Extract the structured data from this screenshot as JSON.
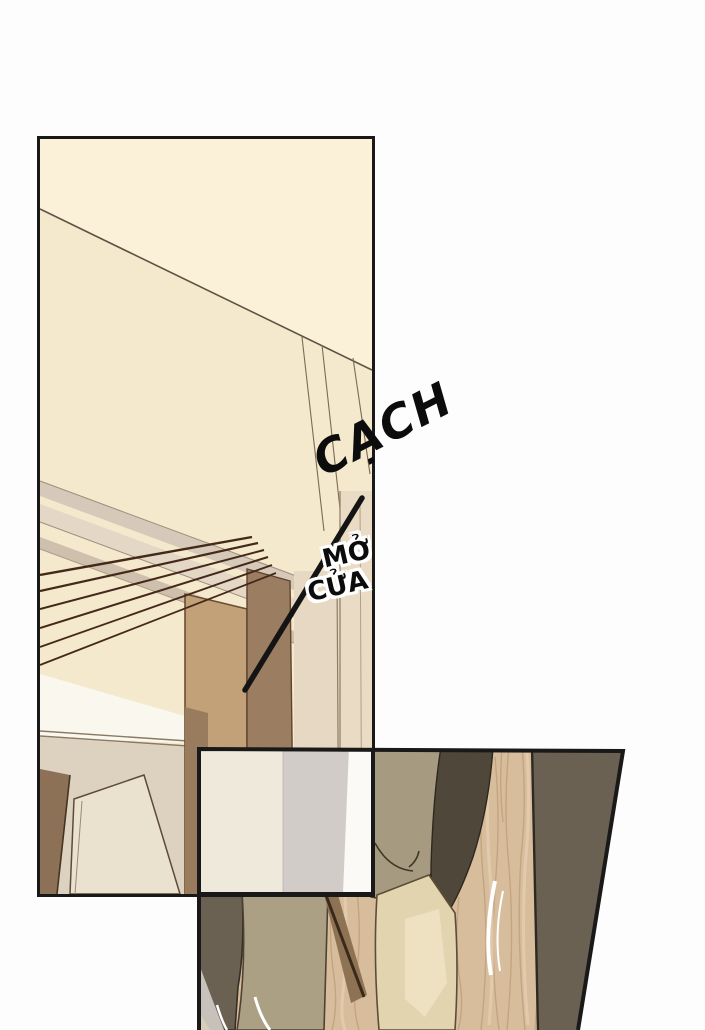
{
  "page": {
    "kind": "comic page",
    "background": "#fdfdfd",
    "width_px": 705,
    "height_px": 1030
  },
  "sfx": {
    "cach": "CẠCH",
    "mo_cua_line1": "MỞ",
    "mo_cua_line2": "CỬA"
  },
  "panels": [
    {
      "id": "panel-1",
      "description": "tall interior panel: cream wall, slanted ceiling beams, wooden door frame, hallway"
    },
    {
      "id": "panel-2",
      "description": "overlapping lower panel: close-up of legs and feet at an open door on a wood floor"
    }
  ],
  "colors": {
    "panel_border": "#191919",
    "wall_cream_top": "#fbf1d9",
    "wall_cream_lower": "#f4e8cd",
    "beam_band_light": "#e4d7c6",
    "beam_band_mid": "#d7c9b9",
    "rail_line_dark": "#44281a",
    "ceiling_white": "#faf7ef",
    "hall_wall_beige": "#ddd1c0",
    "pillar_light_wood": "#c2a078",
    "pillar_dark_wood": "#9b7e62",
    "door_frame_brown": "#8d7156",
    "wood_floor": "#d8bd9d",
    "wood_grain": "#b6946e",
    "open_door_dark": "#6a6153",
    "trouser_khaki": "#a69b80",
    "shoe_dark_olive": "#4f4739",
    "foot_beige": "#e2d4ae",
    "white_door_stripe_cream": "#efe9dc",
    "white_door_stripe_gray": "#d2ccc8",
    "sfx_text": "#0c0c0c",
    "sfx_halo": "#ffffff"
  }
}
